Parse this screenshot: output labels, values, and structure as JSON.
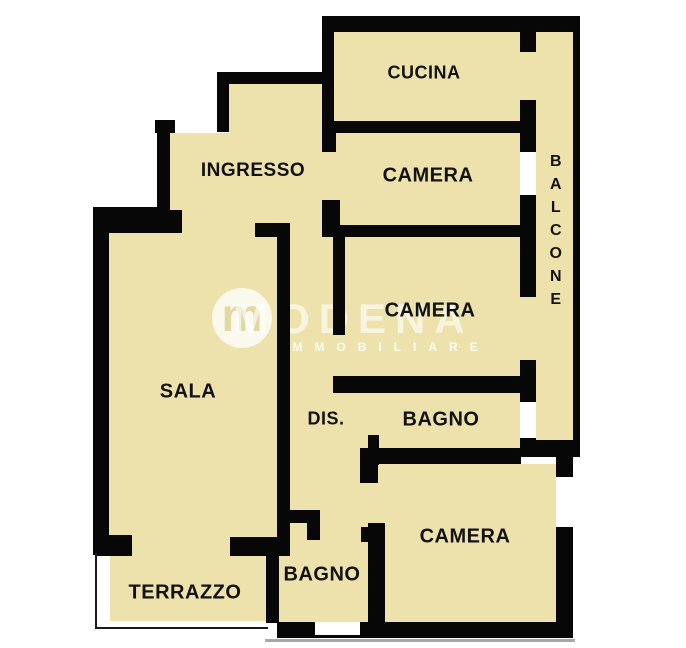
{
  "document": {
    "type": "apartment-floor-plan"
  },
  "colors": {
    "floor": "#EDE2AC",
    "wall": "#070707",
    "window": "#FFFFFF",
    "outside": "#FFFFFF",
    "label": "#121212",
    "thin_outline": "#1a1a1a",
    "shadow": "#A8A8A8"
  },
  "watermark": {
    "brand": "MODENA",
    "sub": "IMMOBILIARE",
    "logo_letter": "m"
  },
  "rooms": [
    {
      "id": "cucina",
      "label": "CUCINA",
      "x": 424,
      "y": 73,
      "size": 18,
      "vertical": false
    },
    {
      "id": "camera-top",
      "label": "CAMERA",
      "x": 428,
      "y": 176,
      "size": 20,
      "vertical": false
    },
    {
      "id": "ingresso",
      "label": "INGRESSO",
      "x": 253,
      "y": 171,
      "size": 19,
      "vertical": false
    },
    {
      "id": "balcone",
      "label": "BALCONE",
      "x": 556,
      "y": 150,
      "size": 16,
      "vertical": true
    },
    {
      "id": "camera-middle",
      "label": "CAMERA",
      "x": 430,
      "y": 311,
      "size": 20,
      "vertical": false
    },
    {
      "id": "sala",
      "label": "SALA",
      "x": 188,
      "y": 392,
      "size": 20,
      "vertical": false
    },
    {
      "id": "dis",
      "label": "DIS.",
      "x": 326,
      "y": 419,
      "size": 18,
      "vertical": false
    },
    {
      "id": "bagno-middle",
      "label": "BAGNO",
      "x": 441,
      "y": 420,
      "size": 20,
      "vertical": false
    },
    {
      "id": "camera-bottom",
      "label": "CAMERA",
      "x": 465,
      "y": 537,
      "size": 20,
      "vertical": false
    },
    {
      "id": "bagno-bottom",
      "label": "BAGNO",
      "x": 322,
      "y": 575,
      "size": 20,
      "vertical": false
    },
    {
      "id": "terrazzo",
      "label": "TERRAZZO",
      "x": 185,
      "y": 593,
      "size": 20,
      "vertical": false
    }
  ],
  "plan": {
    "width": 686,
    "height": 648,
    "floors": [
      [
        334,
        31,
        186,
        92
      ],
      [
        334,
        133,
        186,
        92
      ],
      [
        536,
        31,
        37,
        409
      ],
      [
        229,
        84,
        105,
        49
      ],
      [
        170,
        133,
        164,
        92
      ],
      [
        290,
        225,
        78,
        298
      ],
      [
        345,
        237,
        175,
        143
      ],
      [
        109,
        230,
        168,
        307
      ],
      [
        379,
        393,
        141,
        55
      ],
      [
        290,
        523,
        78,
        99
      ],
      [
        278,
        556,
        14,
        66
      ],
      [
        378,
        464,
        178,
        158
      ],
      [
        110,
        555,
        157,
        66
      ],
      [
        182,
        213,
        73,
        24
      ],
      [
        132,
        537,
        98,
        19
      ],
      [
        520,
        52,
        16,
        48
      ],
      [
        520,
        297,
        16,
        63
      ],
      [
        322,
        152,
        18,
        48
      ],
      [
        368,
        393,
        11,
        42
      ],
      [
        368,
        483,
        17,
        40
      ]
    ],
    "walls": [
      [
        322,
        16,
        258,
        16
      ],
      [
        573,
        16,
        7,
        441
      ],
      [
        536,
        440,
        44,
        17
      ],
      [
        556,
        450,
        17,
        188
      ],
      [
        277,
        622,
        296,
        16
      ],
      [
        217,
        72,
        117,
        12
      ],
      [
        217,
        72,
        12,
        60
      ],
      [
        155,
        120,
        20,
        13
      ],
      [
        157,
        120,
        13,
        110
      ],
      [
        93,
        207,
        77,
        23
      ],
      [
        93,
        207,
        16,
        348
      ],
      [
        96,
        535,
        36,
        21
      ],
      [
        230,
        537,
        47,
        19
      ],
      [
        266,
        547,
        13,
        76
      ],
      [
        322,
        16,
        12,
        117
      ],
      [
        322,
        121,
        198,
        12
      ],
      [
        322,
        133,
        14,
        19
      ],
      [
        322,
        200,
        18,
        37
      ],
      [
        322,
        225,
        198,
        12
      ],
      [
        93,
        210,
        89,
        23
      ],
      [
        255,
        223,
        35,
        14
      ],
      [
        277,
        223,
        13,
        333
      ],
      [
        333,
        237,
        12,
        98
      ],
      [
        333,
        376,
        187,
        17
      ],
      [
        520,
        30,
        16,
        22
      ],
      [
        520,
        100,
        16,
        52
      ],
      [
        520,
        195,
        16,
        102
      ],
      [
        520,
        360,
        16,
        42
      ],
      [
        520,
        438,
        16,
        19
      ],
      [
        368,
        435,
        11,
        30
      ],
      [
        360,
        448,
        161,
        16
      ],
      [
        360,
        458,
        18,
        25
      ],
      [
        368,
        523,
        17,
        100
      ],
      [
        282,
        510,
        36,
        13
      ],
      [
        307,
        510,
        13,
        30
      ],
      [
        361,
        527,
        17,
        15
      ]
    ],
    "windows": [
      [
        520,
        152,
        16,
        43
      ],
      [
        520,
        402,
        16,
        36
      ],
      [
        556,
        477,
        17,
        50
      ],
      [
        315,
        622,
        45,
        13
      ]
    ],
    "thin_lines": [
      [
        95,
        553,
        2,
        76,
        "#1a1a1a"
      ],
      [
        95,
        627,
        173,
        2,
        "#1a1a1a"
      ],
      [
        265,
        639,
        310,
        3,
        "#A8A8A8"
      ]
    ]
  }
}
